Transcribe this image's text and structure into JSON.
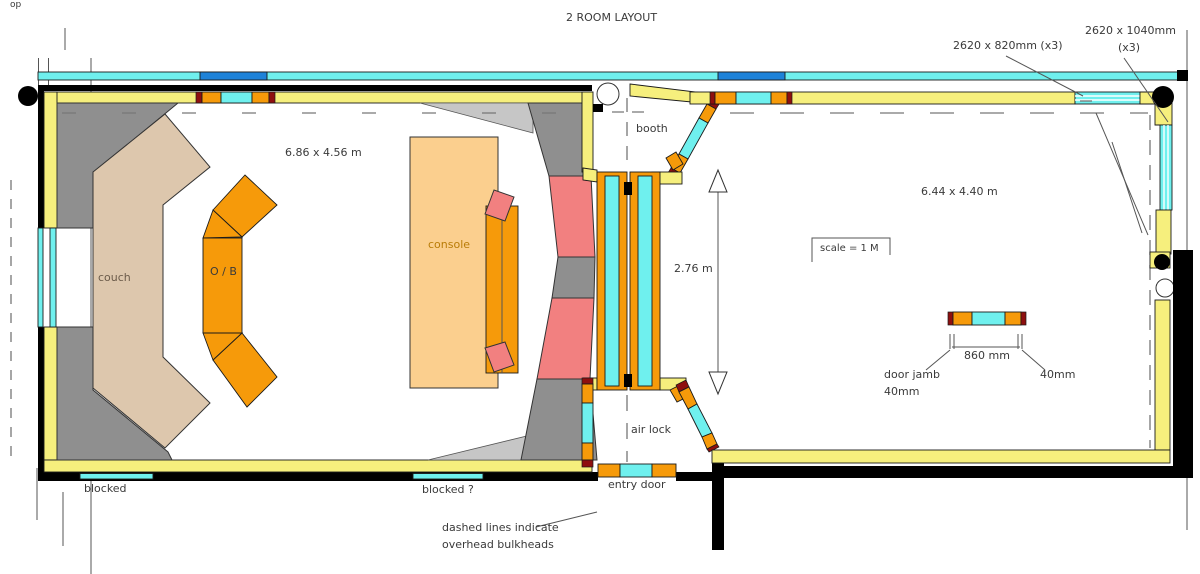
{
  "title": "2 ROOM LAYOUT",
  "corner_note": "op",
  "annotations": {
    "window_top": "2620 x 820mm (x3)",
    "window_right_line1": "2620  x 1040mm",
    "window_right_line2": "(x3)",
    "left_room_size": "6.86 x 4.56 m",
    "right_room_size": "6.44 x 4.40 m",
    "airlock_width": "2.76 m",
    "scale_note": "scale  =  1 M",
    "door_width": "860 mm",
    "door_jamb_line1": "door jamb",
    "door_jamb_line2": "40mm",
    "door_jamb_right": "40mm",
    "blocked_left": "blocked",
    "blocked_center": "blocked ?",
    "bulkhead_note_line1": "dashed lines indicate",
    "bulkhead_note_line2": "overhead bulkheads"
  },
  "room_labels": {
    "couch": "couch",
    "ob_position": "O / B",
    "console": "console",
    "booth": "booth",
    "air_lock": "air lock",
    "entry_door": "entry door"
  },
  "colors": {
    "wall-yellow": "#f6ef7d",
    "glass-cyan": "#6ff0ee",
    "glass-blue": "#1e82d8",
    "frame-orange": "#f69a0a",
    "seal-darkred": "#8e0f0f",
    "trap-gray": "#8f8f8f",
    "trap-lightgray": "#c6c6c6",
    "absorber-pink": "#f28080",
    "couch-tan": "#ddc7ad",
    "console-sand": "#fbcf8e",
    "ink": "#000000",
    "text": "#3a3a3a"
  }
}
